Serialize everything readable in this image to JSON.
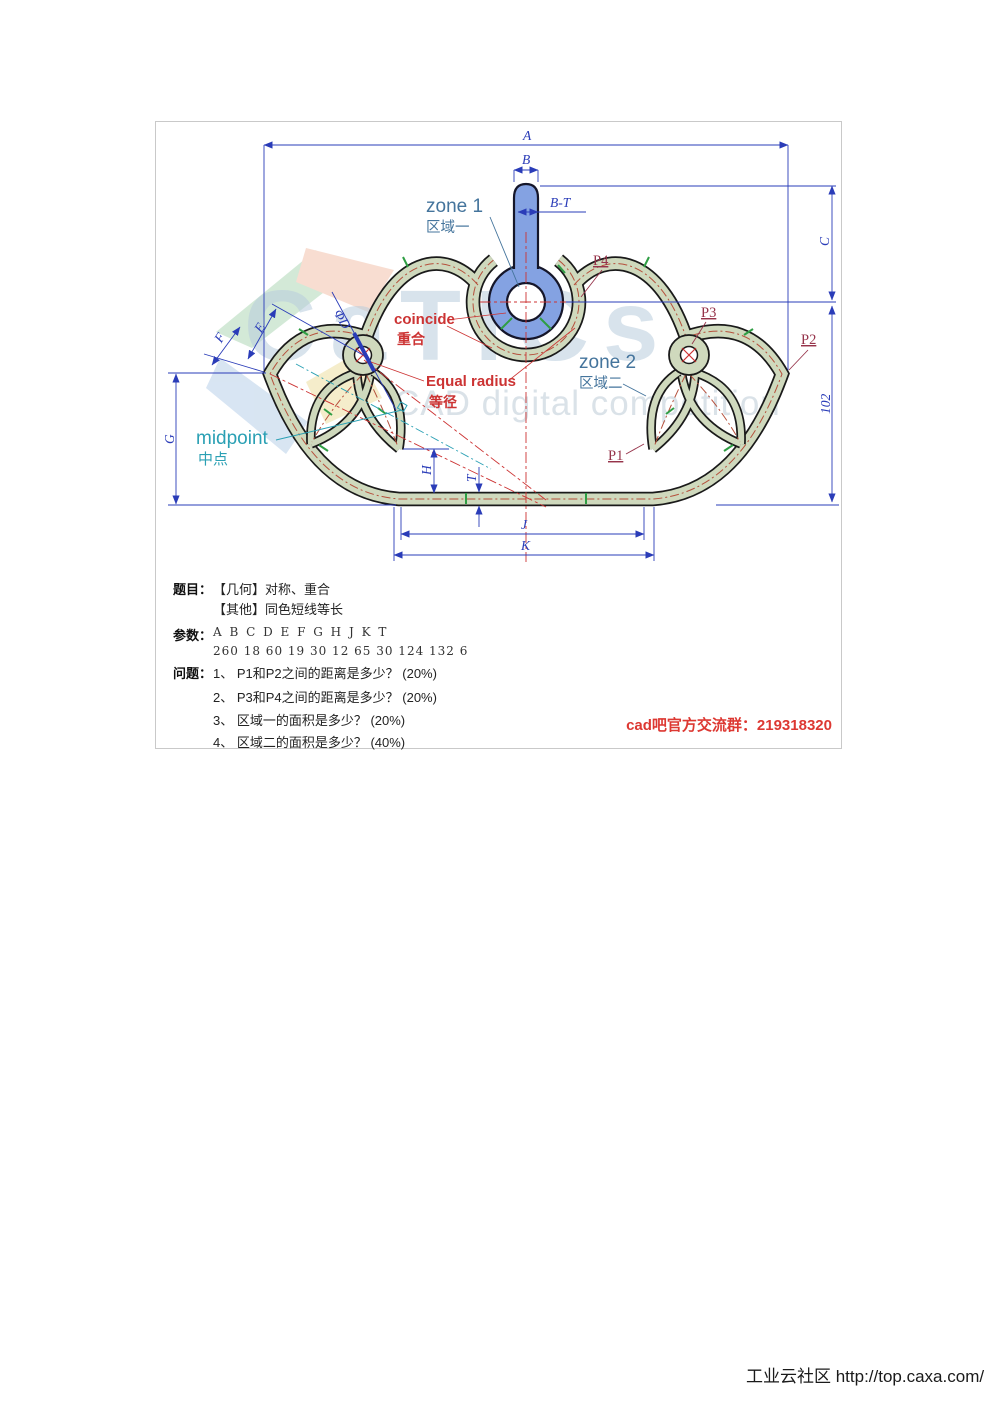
{
  "panel": {
    "watermark": {
      "brand": "CaTICs",
      "tagline": "CAD digital competition"
    },
    "dims": {
      "A": "A",
      "B": "B",
      "BT": "B-T",
      "C": "C",
      "d102": "102",
      "E": "E",
      "F": "F",
      "phiD": "ΦD",
      "G": "G",
      "H": "H",
      "T": "T",
      "J": "J",
      "K": "K"
    },
    "annotations": {
      "zone1_en": "zone 1",
      "zone1_zh": "区域一",
      "zone2_en": "zone 2",
      "zone2_zh": "区域二",
      "coincide_en": "coincide",
      "coincide_zh": "重合",
      "equal_en": "Equal radius",
      "equal_zh": "等径",
      "midpoint_en": "midpoint",
      "midpoint_zh": "中点",
      "p1": "P1",
      "p2": "P2",
      "p3": "P3",
      "p4": "P4"
    },
    "title": {
      "label": "题目：",
      "line1": "【几何】对称、重合",
      "line2": "【其他】同色短线等长"
    },
    "params": {
      "label": "参数：",
      "letters": "A B C D E F G H J K T",
      "values": "260 18 60 19 30 12 65 30 124 132 6",
      "pairs": [
        {
          "name": "A",
          "value": 260
        },
        {
          "name": "B",
          "value": 18
        },
        {
          "name": "C",
          "value": 60
        },
        {
          "name": "D",
          "value": 19
        },
        {
          "name": "E",
          "value": 30
        },
        {
          "name": "F",
          "value": 12
        },
        {
          "name": "G",
          "value": 65
        },
        {
          "name": "H",
          "value": 30
        },
        {
          "name": "J",
          "value": 124
        },
        {
          "name": "K",
          "value": 132
        },
        {
          "name": "T",
          "value": 6
        }
      ]
    },
    "questions": {
      "label": "问题：",
      "items": [
        "1、 P1和P2之间的距离是多少？ (20%)",
        "2、 P3和P4之间的距离是多少？ (20%)",
        "3、 区域一的面积是多少？ (20%)",
        "4、 区域二的面积是多少？ (40%)"
      ]
    },
    "qq_notice": "cad吧官方交流群：219318320"
  },
  "footer": "工业云社区 http://top.caxa.com/"
}
